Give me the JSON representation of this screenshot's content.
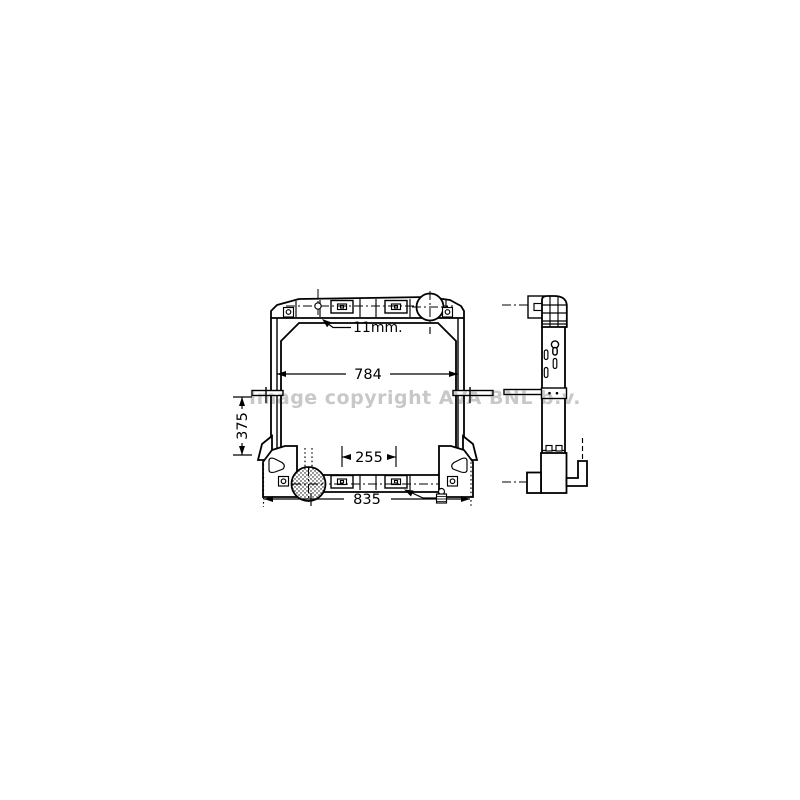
{
  "watermark": {
    "text": "Image copyright AVA BNL b.v.",
    "color": "#c8c8c8"
  },
  "dimensions": {
    "pin_offset": "11mm.",
    "core_width": "784",
    "core_height": "375",
    "port_spacing": "255",
    "overall_width": "835"
  },
  "colors": {
    "line": "#000000",
    "background": "#ffffff",
    "watermark_gray": "#c8c8c8"
  }
}
